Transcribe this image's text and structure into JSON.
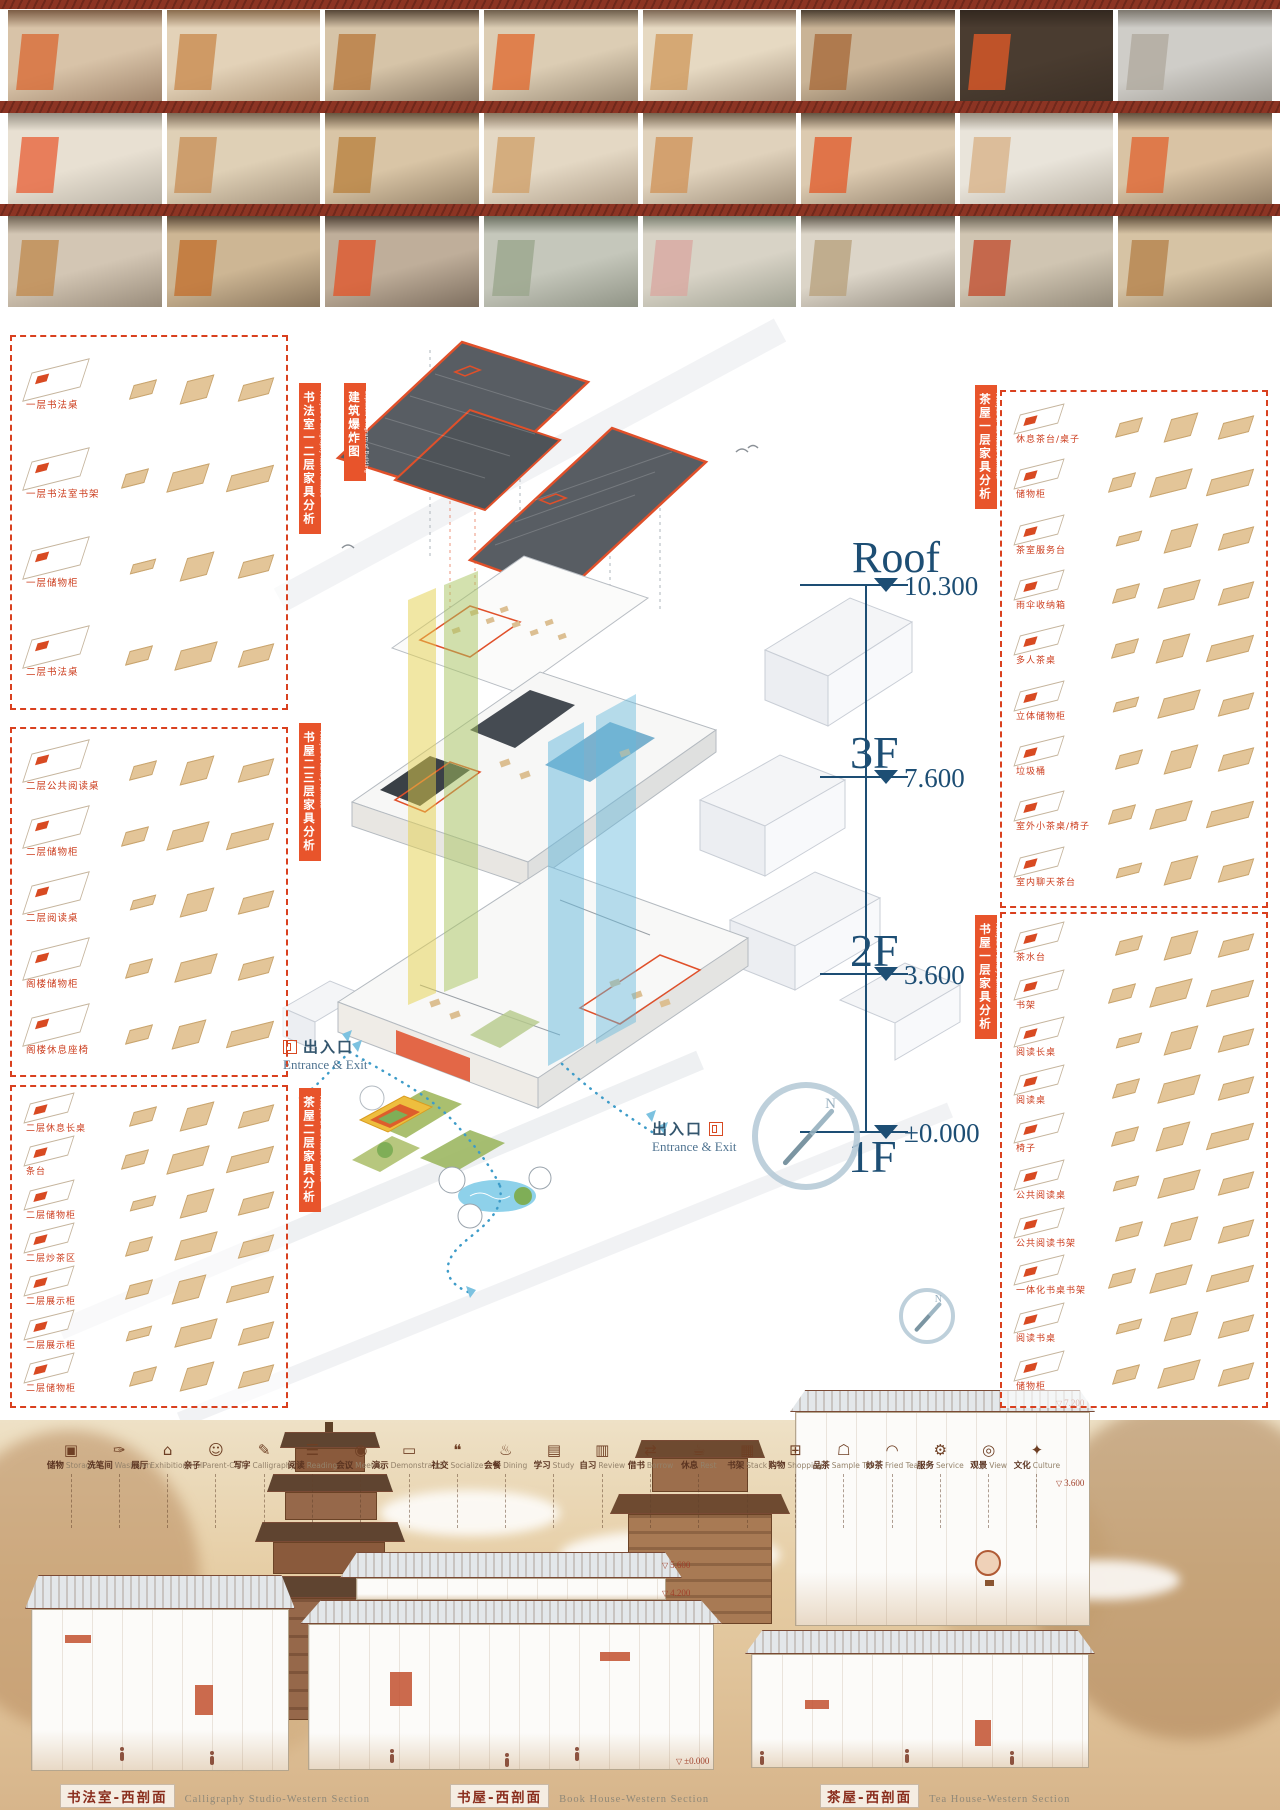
{
  "colors": {
    "accent": "#e0502a",
    "panel_border": "#d9401f",
    "label_red": "#cc3d1e",
    "level_blue": "#1d4e74",
    "ribbon_yellow": "#e3cf4a",
    "ribbon_green": "#a8c45e",
    "ribbon_blue": "#63b8dc",
    "path_blue": "#3e9cc9"
  },
  "photo_rows": [
    {
      "photos": [
        {
          "base": "#d8c3a8",
          "accent": "#d96a35",
          "dark": "#6b4a33"
        },
        {
          "base": "#e3d2b8",
          "accent": "#c98a4e",
          "dark": "#7a5a3a"
        },
        {
          "base": "#d6c4a8",
          "accent": "#b87a3e",
          "dark": "#3f2f22"
        },
        {
          "base": "#dccdb4",
          "accent": "#e06a30",
          "dark": "#5a4a38"
        },
        {
          "base": "#e6d9c2",
          "accent": "#d09a5e",
          "dark": "#6a5340"
        },
        {
          "base": "#c9b396",
          "accent": "#a86a3a",
          "dark": "#352a1f"
        },
        {
          "base": "#4a3c30",
          "accent": "#e05a28",
          "dark": "#2e241c"
        },
        {
          "base": "#cfcdc8",
          "accent": "#b0a99e",
          "dark": "#6e685e"
        }
      ]
    },
    {
      "photos": [
        {
          "base": "#e8e0d2",
          "accent": "#e8633a",
          "dark": "#8a8478"
        },
        {
          "base": "#dfd0b6",
          "accent": "#c89058",
          "dark": "#6b5845"
        },
        {
          "base": "#d9c5a6",
          "accent": "#b9813f",
          "dark": "#54422e"
        },
        {
          "base": "#e4d8c4",
          "accent": "#cfa06a",
          "dark": "#7a6650"
        },
        {
          "base": "#e0d2bc",
          "accent": "#d0945a",
          "dark": "#62503c"
        },
        {
          "base": "#dccab0",
          "accent": "#e25c2c",
          "dark": "#50402f"
        },
        {
          "base": "#e9e4da",
          "accent": "#d8b288",
          "dark": "#8a8070"
        },
        {
          "base": "#d9c3a4",
          "accent": "#df6532",
          "dark": "#4f3e2d"
        }
      ]
    },
    {
      "photos": [
        {
          "base": "#d3c6b4",
          "accent": "#c08a50",
          "dark": "#5f5242"
        },
        {
          "base": "#cdb694",
          "accent": "#c2702e",
          "dark": "#473626"
        },
        {
          "base": "#bfae9a",
          "accent": "#e0562a",
          "dark": "#3c2f24"
        },
        {
          "base": "#c5c7bb",
          "accent": "#9aa58c",
          "dark": "#5c6152"
        },
        {
          "base": "#d8d3c6",
          "accent": "#d9a8a0",
          "dark": "#6b7262"
        },
        {
          "base": "#dcd5c8",
          "accent": "#b9a17e",
          "dark": "#4e463a"
        },
        {
          "base": "#d0c5b2",
          "accent": "#c24e30",
          "dark": "#5a5244"
        },
        {
          "base": "#d6c3a4",
          "accent": "#b5824a",
          "dark": "#4b3a28"
        }
      ]
    }
  ],
  "left_panels": [
    {
      "tab_zh": "书法室一二层家具分析",
      "tab_en": "Analysis of Calligraphy Room Furniture",
      "items": [
        "一层书法桌",
        "一层书法室书架",
        "一层储物柜",
        "二层书法桌"
      ]
    },
    {
      "tab_zh": "书屋二三层家具分析",
      "tab_en": "Analysis of Library Furniture",
      "items": [
        "二层公共阅读桌",
        "二层储物柜",
        "二层阅读桌",
        "阁楼储物柜",
        "阁楼休息座椅"
      ]
    },
    {
      "tab_zh": "茶屋二层家具分析",
      "tab_en": "Analysis of Tea House Furniture",
      "items": [
        "二层休息长桌",
        "条台",
        "二层储物柜",
        "二层炒茶区",
        "二层展示柜",
        "二层展示柜",
        "二层储物柜"
      ]
    }
  ],
  "right_panels": [
    {
      "tab_zh": "茶屋一层家具分析",
      "tab_en": "Analysis of Tea House Furniture",
      "items": [
        "休息茶台/桌子",
        "储物柜",
        "茶室服务台",
        "雨伞收纳箱",
        "多人茶桌",
        "立体储物柜",
        "垃圾桶",
        "室外小茶桌/椅子",
        "室内聊天茶台"
      ]
    },
    {
      "tab_zh": "书屋一层家具分析",
      "tab_en": "Analysis of Library Furniture",
      "items": [
        "茶水台",
        "书架",
        "阅读长桌",
        "阅读桌",
        "椅子",
        "公共阅读桌",
        "公共阅读书架",
        "一体化书桌书架",
        "阅读书桌",
        "储物柜"
      ]
    }
  ],
  "exploded": {
    "tab_zh": "建筑爆炸图",
    "tab_en": "Exploded Diagram of Building",
    "levels": [
      {
        "name": "Roof",
        "elev": "10.300"
      },
      {
        "name": "3F",
        "elev": "7.600"
      },
      {
        "name": "2F",
        "elev": "3.600"
      },
      {
        "name": "1F",
        "elev": "±0.000"
      }
    ],
    "entrance_zh": "出入口",
    "entrance_en": "Entrance & Exit",
    "compass_label": "N"
  },
  "program_icons": [
    {
      "glyph": "▣",
      "zh": "储物",
      "en": "Storage"
    },
    {
      "glyph": "✑",
      "zh": "洗笔间",
      "en": "Wash pen"
    },
    {
      "glyph": "⌂",
      "zh": "展厅",
      "en": "Exhibition Hall"
    },
    {
      "glyph": "☺",
      "zh": "亲子",
      "en": "Parent-Child"
    },
    {
      "glyph": "✎",
      "zh": "写字",
      "en": "Calligraphy"
    },
    {
      "glyph": "☰",
      "zh": "阅读",
      "en": "Reading"
    },
    {
      "glyph": "◉",
      "zh": "会议",
      "en": "Meeting"
    },
    {
      "glyph": "▭",
      "zh": "演示",
      "en": "Demonstration"
    },
    {
      "glyph": "❝",
      "zh": "社交",
      "en": "Socialize"
    },
    {
      "glyph": "♨",
      "zh": "会餐",
      "en": "Dining"
    },
    {
      "glyph": "▤",
      "zh": "学习",
      "en": "Study"
    },
    {
      "glyph": "▥",
      "zh": "自习",
      "en": "Review"
    },
    {
      "glyph": "⇄",
      "zh": "借书",
      "en": "Borrow"
    },
    {
      "glyph": "☕",
      "zh": "休息",
      "en": "Rest"
    },
    {
      "glyph": "▦",
      "zh": "书架",
      "en": "Stack"
    },
    {
      "glyph": "⊞",
      "zh": "购物",
      "en": "Shopping"
    },
    {
      "glyph": "☖",
      "zh": "品茶",
      "en": "Sample Tea"
    },
    {
      "glyph": "◠",
      "zh": "炒茶",
      "en": "Fried Tea"
    },
    {
      "glyph": "⚙",
      "zh": "服务",
      "en": "Service"
    },
    {
      "glyph": "◎",
      "zh": "观景",
      "en": "View"
    },
    {
      "glyph": "✦",
      "zh": "文化",
      "en": "Culture"
    }
  ],
  "bottom": {
    "elevation_marks": [
      "5.600",
      "4.200",
      "±0.000",
      "7.200",
      "3.600"
    ],
    "titles": [
      {
        "zh": "书法室-西剖面",
        "en": "Calligraphy Studio-Western Section"
      },
      {
        "zh": "书屋-西剖面",
        "en": "Book House-Western Section"
      },
      {
        "zh": "茶屋-西剖面",
        "en": "Tea House-Western Section"
      }
    ]
  }
}
